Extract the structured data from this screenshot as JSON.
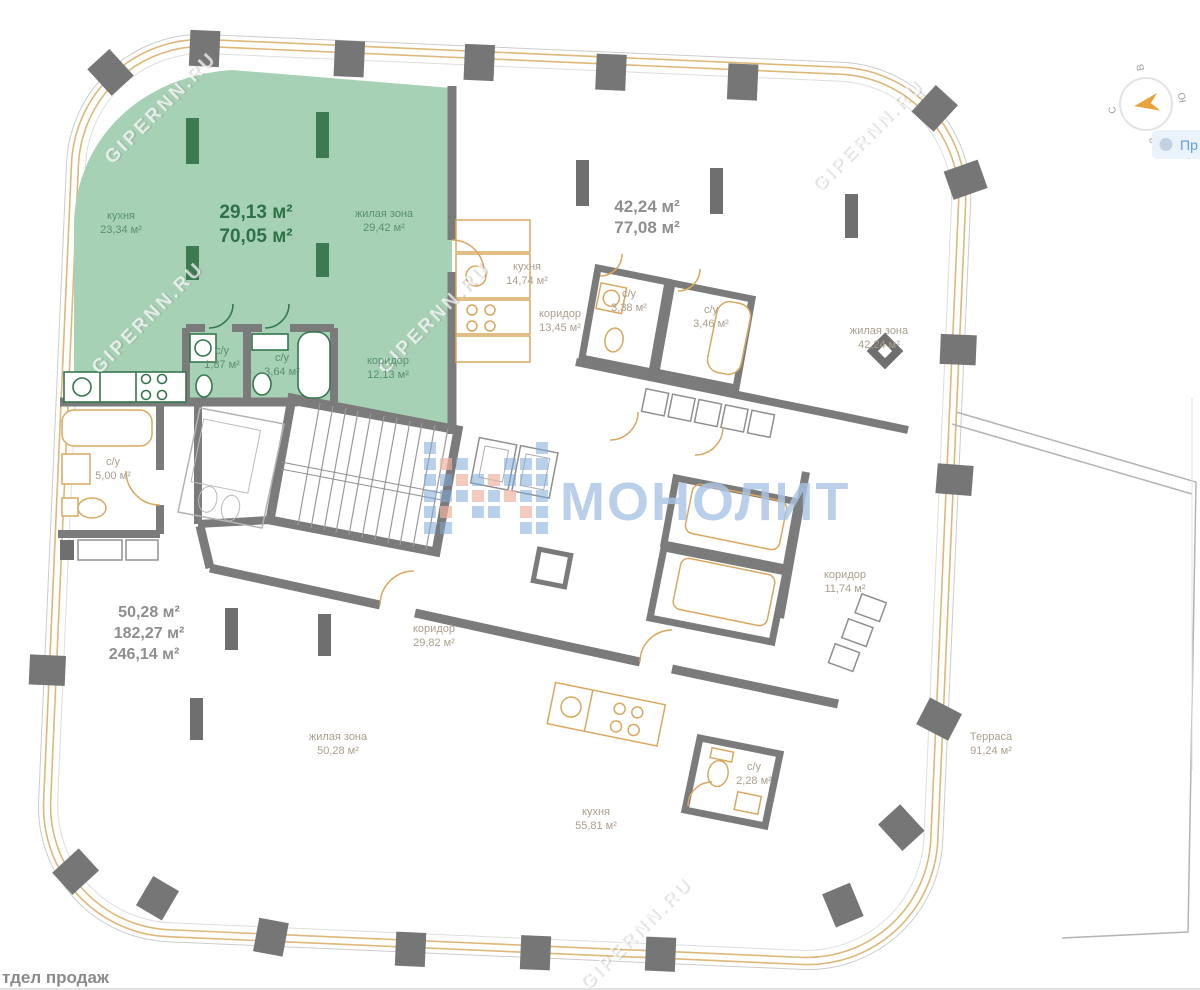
{
  "branding": {
    "logo_text": "МОНОЛИТ",
    "watermark": "GIPERNN.RU"
  },
  "legend": {
    "chip_label": "Пр"
  },
  "footer": {
    "sales_office": "тдел продаж"
  },
  "compass": {
    "north": "С",
    "east": "В",
    "south": "Ю",
    "west": "З"
  },
  "plan": {
    "unit_green": {
      "area_line1": "29,13 м²",
      "area_line2": "70,05 м²",
      "kitchen_name": "кухня",
      "kitchen_area": "23,34 м²",
      "living_name": "жилая зона",
      "living_area": "29,42 м²",
      "bath1_name": "с/у",
      "bath1_area": "1,87 м²",
      "bath2_name": "с/у",
      "bath2_area": "3,64 м²",
      "hall_name": "коридор",
      "hall_area": "12,13 м²"
    },
    "unit_right": {
      "area_line1": "42,24 м²",
      "area_line2": "77,08 м²",
      "kitchen_name": "кухня",
      "kitchen_area": "14,74 м²",
      "hall_name": "коридор",
      "hall_area": "13,45 м²",
      "bath1_name": "с/у",
      "bath1_area": "3,38 м²",
      "bath2_name": "с/у",
      "bath2_area": "3,46 м²",
      "living_name": "жилая зона",
      "living_area": "42,24 м²"
    },
    "unit_big": {
      "area_line1": "50,28 м²",
      "area_line2": "182,27 м²",
      "area_line3": "246,14 м²",
      "bath_left_name": "с/у",
      "bath_left_area": "5,00 м²",
      "hall_name": "коридор",
      "hall_area": "29,82 м²",
      "living_name": "жилая зона",
      "living_area": "50,28 м²",
      "kitchen_name": "кухня",
      "kitchen_area": "55,81 м²",
      "bath_name": "с/у",
      "bath_area": "2,28 м²",
      "hall2_name": "коридор",
      "hall2_area": "11,74 м²"
    },
    "terrace": {
      "name": "Терраса",
      "area": "91,24 м²"
    }
  },
  "colors": {
    "highlight": "#a7d1b5",
    "wall": "#7b7b7b",
    "window_band": "#dcb36f",
    "fixture": "#d9a85f",
    "green_dark": "#35774d",
    "logo_blue": "#a9c4e6"
  }
}
